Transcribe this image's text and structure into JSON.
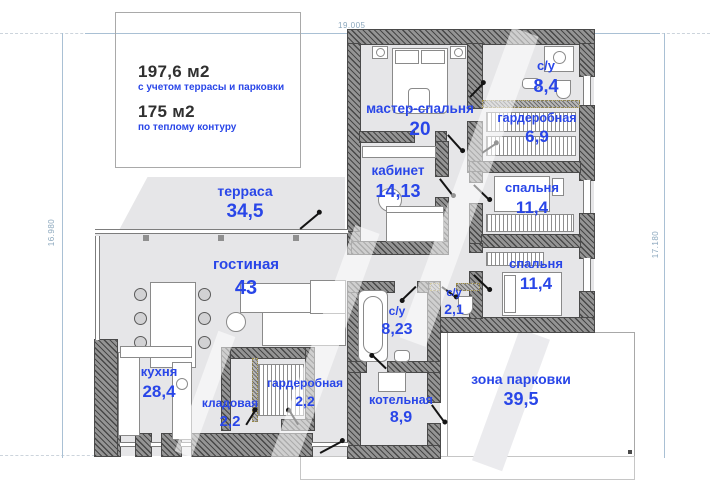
{
  "title_block": {
    "total_area": "197,6 м2",
    "total_area_caption": "с учетом террасы и парковки",
    "heated_area": "175 м2",
    "heated_area_caption": "по теплому контуру"
  },
  "dimensions": {
    "top": "19.005",
    "left": "16.980",
    "right": "17.180"
  },
  "rooms": [
    {
      "id": "terrace",
      "name": "терраса",
      "area": "34,5"
    },
    {
      "id": "living",
      "name": "гостиная",
      "area": "43"
    },
    {
      "id": "master",
      "name": "мастер-спальня",
      "area": "20"
    },
    {
      "id": "cabinet",
      "name": "кабинет",
      "area": "14,13"
    },
    {
      "id": "bath-main",
      "name": "с/у",
      "area": "8,4"
    },
    {
      "id": "wardrobe-main",
      "name": "гардеробная",
      "area": "6,9"
    },
    {
      "id": "bedroom-1",
      "name": "спальня",
      "area": "11,4"
    },
    {
      "id": "bedroom-2",
      "name": "спальня",
      "area": "11,4"
    },
    {
      "id": "bath-small",
      "name": "с/у",
      "area": "2,1"
    },
    {
      "id": "bath-2",
      "name": "с/у",
      "area": "8,23"
    },
    {
      "id": "kitchen",
      "name": "кухня",
      "area": "28,4"
    },
    {
      "id": "pantry",
      "name": "кладовая",
      "area": "2,2"
    },
    {
      "id": "wardrobe-small",
      "name": "гардеробная",
      "area": "2,2"
    },
    {
      "id": "boiler",
      "name": "котельная",
      "area": "8,9"
    },
    {
      "id": "parking",
      "name": "зона парковки",
      "area": "39,5"
    }
  ],
  "colors": {
    "label_blue": "#2946e8",
    "wall_dark": "#474747",
    "floor_gray": "#e6e6e8",
    "dim_blue": "#8ba7bd"
  }
}
